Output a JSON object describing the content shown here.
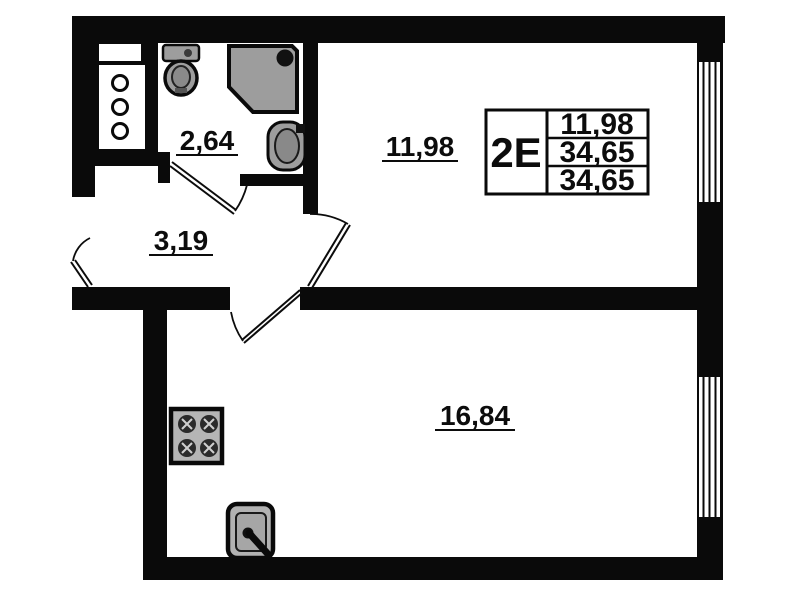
{
  "plan": {
    "info_table": {
      "unit_type": "2E",
      "rows": [
        "11,98",
        "34,65",
        "34,65"
      ]
    },
    "rooms": [
      {
        "id": "bathroom",
        "area": "2,64"
      },
      {
        "id": "hallway",
        "area": "3,19"
      },
      {
        "id": "living-room",
        "area": "11,98"
      },
      {
        "id": "kitchen-living-room",
        "area": "16,84"
      }
    ],
    "colors": {
      "wall": "#0a0a0a",
      "fixture_fill": "#9d9d9d",
      "background": "#ffffff"
    }
  }
}
